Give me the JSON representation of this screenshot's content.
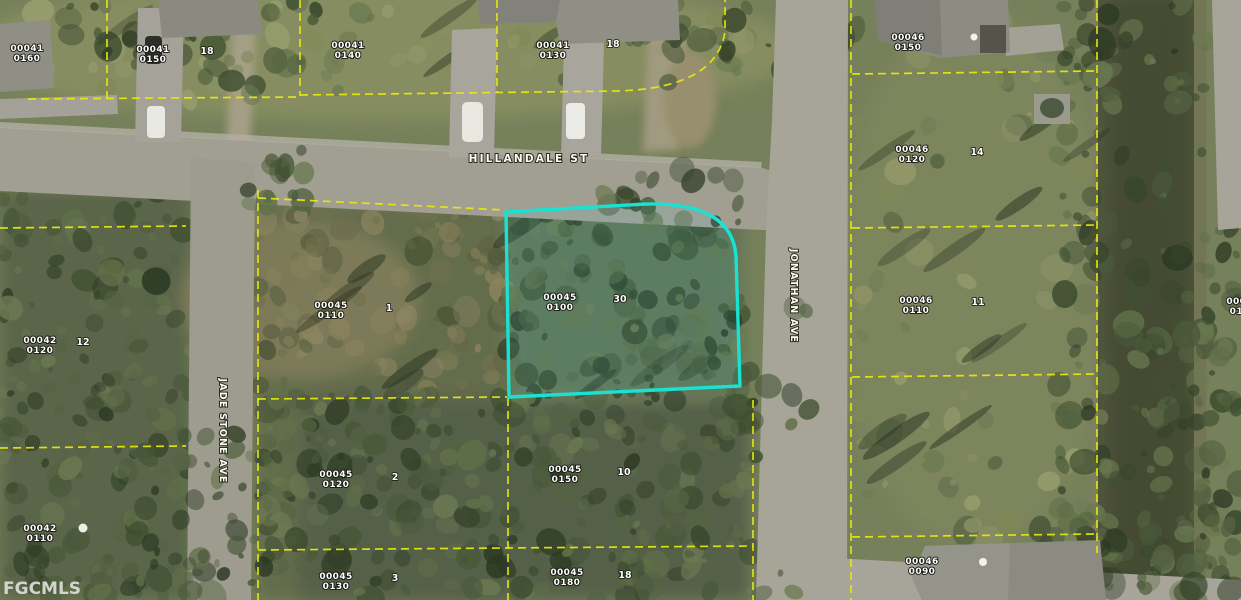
{
  "watermark": {
    "text": "FGCMLS"
  },
  "streets": {
    "hillandale": {
      "name": "HILLANDALE ST"
    },
    "jade_stone": {
      "name": "JADE STONE AVE"
    },
    "jonathan": {
      "name": "JONATHAN AVE"
    }
  },
  "subject_parcel": {
    "strap_line1": "00045",
    "strap_line2": "0100",
    "lot_marker": "30",
    "outline_color": "#19e2d3"
  },
  "parcel_labels": [
    {
      "line1": "00041",
      "line2": "0160"
    },
    {
      "line1": "00041",
      "line2": "0150",
      "marker": "18"
    },
    {
      "line1": "00041",
      "line2": "0140"
    },
    {
      "line1": "00041",
      "line2": "0130",
      "marker": "18"
    },
    {
      "line1": "00046",
      "line2": "0150"
    },
    {
      "line1": "00046",
      "line2": "0120",
      "marker": "14"
    },
    {
      "line1": "00046",
      "line2": "0110",
      "marker": "11"
    },
    {
      "line1": "00046",
      "line2": "0090"
    },
    {
      "line1": "00042",
      "line2": "0120",
      "marker": "12"
    },
    {
      "line1": "00042",
      "line2": "0110"
    },
    {
      "line1": "00045",
      "line2": "0110",
      "marker": "1"
    },
    {
      "line1": "00045",
      "line2": "0120",
      "marker": "2"
    },
    {
      "line1": "00045",
      "line2": "0130",
      "marker": "3"
    },
    {
      "line1": "00045",
      "line2": "0150",
      "marker": "10"
    },
    {
      "line1": "00045",
      "line2": "0180",
      "marker": "18"
    },
    {
      "line1": "00046",
      "line2": "0130"
    }
  ],
  "colors": {
    "parcel_line": "#e9e90c",
    "subject_outline": "#19e2d3",
    "label_text": "#ffffff"
  }
}
